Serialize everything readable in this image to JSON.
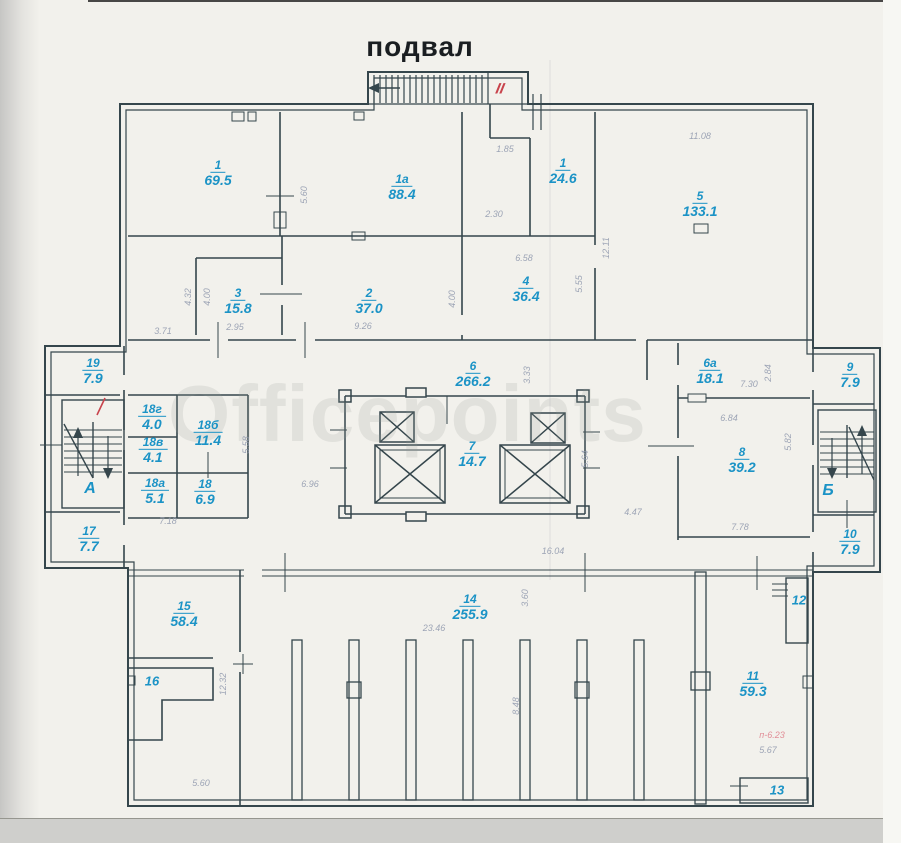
{
  "title": "подвал",
  "watermark": "Officepoints",
  "colors": {
    "wall": "#35464c",
    "label_blue": "#1b93c6",
    "dim_gray": "#8e97ac",
    "red": "#c8434c",
    "paper": "#f2f1ec"
  },
  "marks": {
    "section": "II",
    "stair_note": "п-6.23"
  },
  "stairs": [
    {
      "label": "А",
      "x": 90,
      "y": 489
    },
    {
      "label": "Б",
      "x": 828,
      "y": 491
    }
  ],
  "rooms": [
    {
      "num": "1",
      "area": "69.5",
      "x": 218,
      "y": 172
    },
    {
      "num": "1а",
      "area": "88.4",
      "x": 402,
      "y": 186
    },
    {
      "num": "1",
      "area": "24.6",
      "x": 563,
      "y": 170
    },
    {
      "num": "5",
      "area": "133.1",
      "x": 700,
      "y": 203
    },
    {
      "num": "3",
      "area": "15.8",
      "x": 238,
      "y": 300
    },
    {
      "num": "2",
      "area": "37.0",
      "x": 369,
      "y": 300
    },
    {
      "num": "4",
      "area": "36.4",
      "x": 526,
      "y": 288
    },
    {
      "num": "6",
      "area": "266.2",
      "x": 473,
      "y": 373
    },
    {
      "num": "6а",
      "area": "18.1",
      "x": 710,
      "y": 370
    },
    {
      "num": "9",
      "area": "7.9",
      "x": 850,
      "y": 374
    },
    {
      "num": "19",
      "area": "7.9",
      "x": 93,
      "y": 370
    },
    {
      "num": "18г",
      "area": "4.0",
      "x": 152,
      "y": 416
    },
    {
      "num": "18б",
      "area": "11.4",
      "x": 208,
      "y": 432
    },
    {
      "num": "18в",
      "area": "4.1",
      "x": 153,
      "y": 449
    },
    {
      "num": "18а",
      "area": "5.1",
      "x": 155,
      "y": 490
    },
    {
      "num": "18",
      "area": "6.9",
      "x": 205,
      "y": 491
    },
    {
      "num": "7",
      "area": "14.7",
      "x": 472,
      "y": 453
    },
    {
      "num": "8",
      "area": "39.2",
      "x": 742,
      "y": 459
    },
    {
      "num": "17",
      "area": "7.7",
      "x": 89,
      "y": 538
    },
    {
      "num": "10",
      "area": "7.9",
      "x": 850,
      "y": 541
    },
    {
      "num": "15",
      "area": "58.4",
      "x": 184,
      "y": 613
    },
    {
      "num": "16",
      "area": "",
      "x": 152,
      "y": 681
    },
    {
      "num": "14",
      "area": "255.9",
      "x": 470,
      "y": 606
    },
    {
      "num": "12",
      "area": "",
      "x": 799,
      "y": 600
    },
    {
      "num": "11",
      "area": "59.3",
      "x": 753,
      "y": 683
    },
    {
      "num": "13",
      "area": "",
      "x": 777,
      "y": 790
    }
  ],
  "dims": [
    {
      "t": "5.60",
      "x": 304,
      "y": 195,
      "r": 90
    },
    {
      "t": "1.85",
      "x": 505,
      "y": 149,
      "r": 0
    },
    {
      "t": "2.30",
      "x": 494,
      "y": 214,
      "r": 0
    },
    {
      "t": "11.08",
      "x": 700,
      "y": 136,
      "r": 0
    },
    {
      "t": "12.11",
      "x": 606,
      "y": 248,
      "r": 90
    },
    {
      "t": "5.55",
      "x": 579,
      "y": 284,
      "r": 90
    },
    {
      "t": "6.58",
      "x": 524,
      "y": 258,
      "r": 0
    },
    {
      "t": "4.00",
      "x": 452,
      "y": 299,
      "r": 90
    },
    {
      "t": "4.00",
      "x": 207,
      "y": 297,
      "r": 90
    },
    {
      "t": "4.32",
      "x": 188,
      "y": 297,
      "r": 90
    },
    {
      "t": "2.95",
      "x": 235,
      "y": 327,
      "r": 0
    },
    {
      "t": "9.26",
      "x": 363,
      "y": 326,
      "r": 0
    },
    {
      "t": "3.71",
      "x": 163,
      "y": 331,
      "r": 0
    },
    {
      "t": "3.33",
      "x": 527,
      "y": 375,
      "r": 90
    },
    {
      "t": "5.58",
      "x": 246,
      "y": 445,
      "r": 90
    },
    {
      "t": "6.96",
      "x": 310,
      "y": 484,
      "r": 0
    },
    {
      "t": "7.18",
      "x": 168,
      "y": 521,
      "r": 0
    },
    {
      "t": "5.64",
      "x": 585,
      "y": 459,
      "r": 90
    },
    {
      "t": "4.47",
      "x": 633,
      "y": 512,
      "r": 0
    },
    {
      "t": "16.04",
      "x": 553,
      "y": 551,
      "r": 0
    },
    {
      "t": "7.30",
      "x": 749,
      "y": 384,
      "r": 0
    },
    {
      "t": "2.84",
      "x": 768,
      "y": 373,
      "r": 90
    },
    {
      "t": "6.84",
      "x": 729,
      "y": 418,
      "r": 0
    },
    {
      "t": "5.82",
      "x": 788,
      "y": 442,
      "r": 90
    },
    {
      "t": "7.78",
      "x": 740,
      "y": 527,
      "r": 0
    },
    {
      "t": "23.46",
      "x": 434,
      "y": 628,
      "r": 0
    },
    {
      "t": "3.60",
      "x": 525,
      "y": 598,
      "r": 90
    },
    {
      "t": "8.48",
      "x": 516,
      "y": 706,
      "r": 90
    },
    {
      "t": "12.32",
      "x": 223,
      "y": 684,
      "r": 90
    },
    {
      "t": "5.60",
      "x": 201,
      "y": 783,
      "r": 0
    },
    {
      "t": "5.67",
      "x": 768,
      "y": 750,
      "r": 0
    }
  ]
}
